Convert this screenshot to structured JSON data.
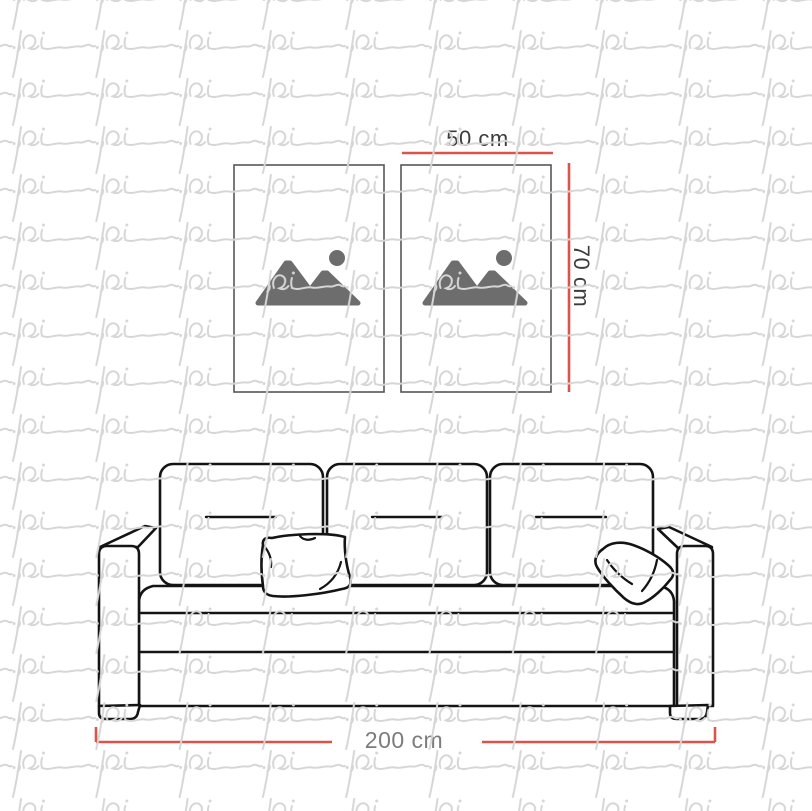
{
  "watermark": {
    "text": "pi",
    "color": "#d6d6d6"
  },
  "dimensions": {
    "frame_width": "50 cm",
    "frame_height": "70 cm",
    "sofa_width": "200 cm"
  },
  "colors": {
    "background": "#ffffff",
    "dimension_line": "#dc534b",
    "frame_width_label": "#3c3c3c",
    "frame_height_label": "#3c3c3c",
    "sofa_width_label": "#7c7c7c",
    "sofa_outline": "#141414",
    "frame_border": "#565656",
    "image_placeholder_icon": "#6d6d6d"
  },
  "scene": {
    "wall_frames": 2,
    "sofa_back_cushions": 3,
    "throw_pillows": 2
  }
}
